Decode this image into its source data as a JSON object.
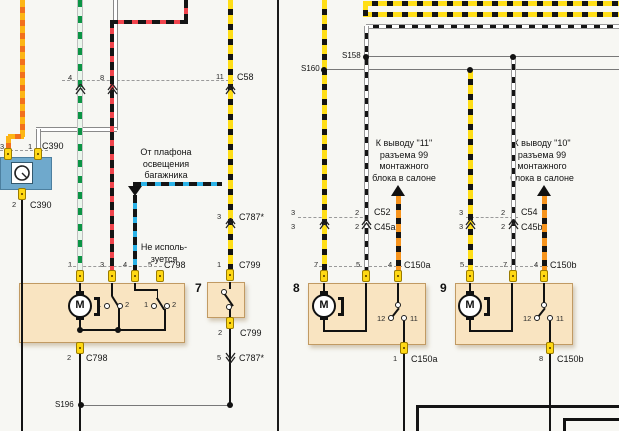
{
  "diagram_title": "wiring-diagram-trunk-window-motors",
  "labels": {
    "pin3_c390": "3",
    "pin1_c390": "1",
    "c390_top": "C390",
    "pin2_c390": "2",
    "c390_bot": "C390",
    "pin4_c58": "4",
    "pin8_c58": "8",
    "pin11_c58": "11",
    "c58": "C58",
    "pin3_c787": "3",
    "c787_top": "C787*",
    "pin1_c799": "1",
    "c799_top": "C799",
    "pin2_c799": "2",
    "c799_bot": "C799",
    "pin5_c787": "5",
    "c787_bot": "C787*",
    "s196": "S196",
    "s158": "S158",
    "s160": "S160",
    "comp6": "6",
    "comp7": "7",
    "comp8": "8",
    "comp9": "9",
    "pin1_6": "1",
    "pin3_6": "3",
    "pin4_6": "4",
    "pin5_6": "5",
    "c798_top": "C798",
    "pin2_c798": "2",
    "c798_bot": "C798",
    "sw1_1": "1",
    "sw1_2": "2",
    "sw2_1": "1",
    "sw2_2": "2",
    "motor6": "M",
    "motor8": "M",
    "motor9": "M",
    "pin3a_c52": "3",
    "pin3b_c45a": "3",
    "pin2a_c52": "2",
    "pin2b_c45a": "2",
    "c52": "C52",
    "c45a": "C45a",
    "pin3a_c54": "3",
    "pin3b_c45b": "3",
    "pin2a_c54": "2",
    "pin2b_c45b": "2",
    "c54": "C54",
    "c45b": "C45b",
    "pin7_8": "7",
    "pin5_8": "5",
    "pin4_8": "4",
    "c150a_top": "C150a",
    "sw8_12": "12",
    "sw8_11": "11",
    "pin1_8": "1",
    "c150a_bot": "C150a",
    "pin5_9": "5",
    "pin7_9": "7",
    "pin4_9": "4",
    "c150b_top": "C150b",
    "sw9_12": "12",
    "sw9_11": "11",
    "pin8_9": "8",
    "c150b_bot": "C150b"
  },
  "notes": {
    "trunk_lamp": "От плафона\nосвещения\nбагажника",
    "not_used": "Не исполь-\nзуется",
    "to_pin11": "К выводу \"11\"\nразъема 99\nмонтажного\nблока в салоне",
    "to_pin10": "К выводу \"10\"\nразъема 99\nмонтажного\nблока в салоне"
  },
  "wire_colors": {
    "yellow_black": "#ffde17",
    "orange_black": "#f7941d",
    "black_red": "#f0444c",
    "black_blue": "#2bb3e8",
    "green_white": "#0b9444",
    "orange": "#fdb515",
    "black": "#141414",
    "component_fill": "#f9e4c1",
    "component_border": "#c19a63",
    "blue_component": "#6fa9cc",
    "connector_pin": "#ffd814"
  }
}
